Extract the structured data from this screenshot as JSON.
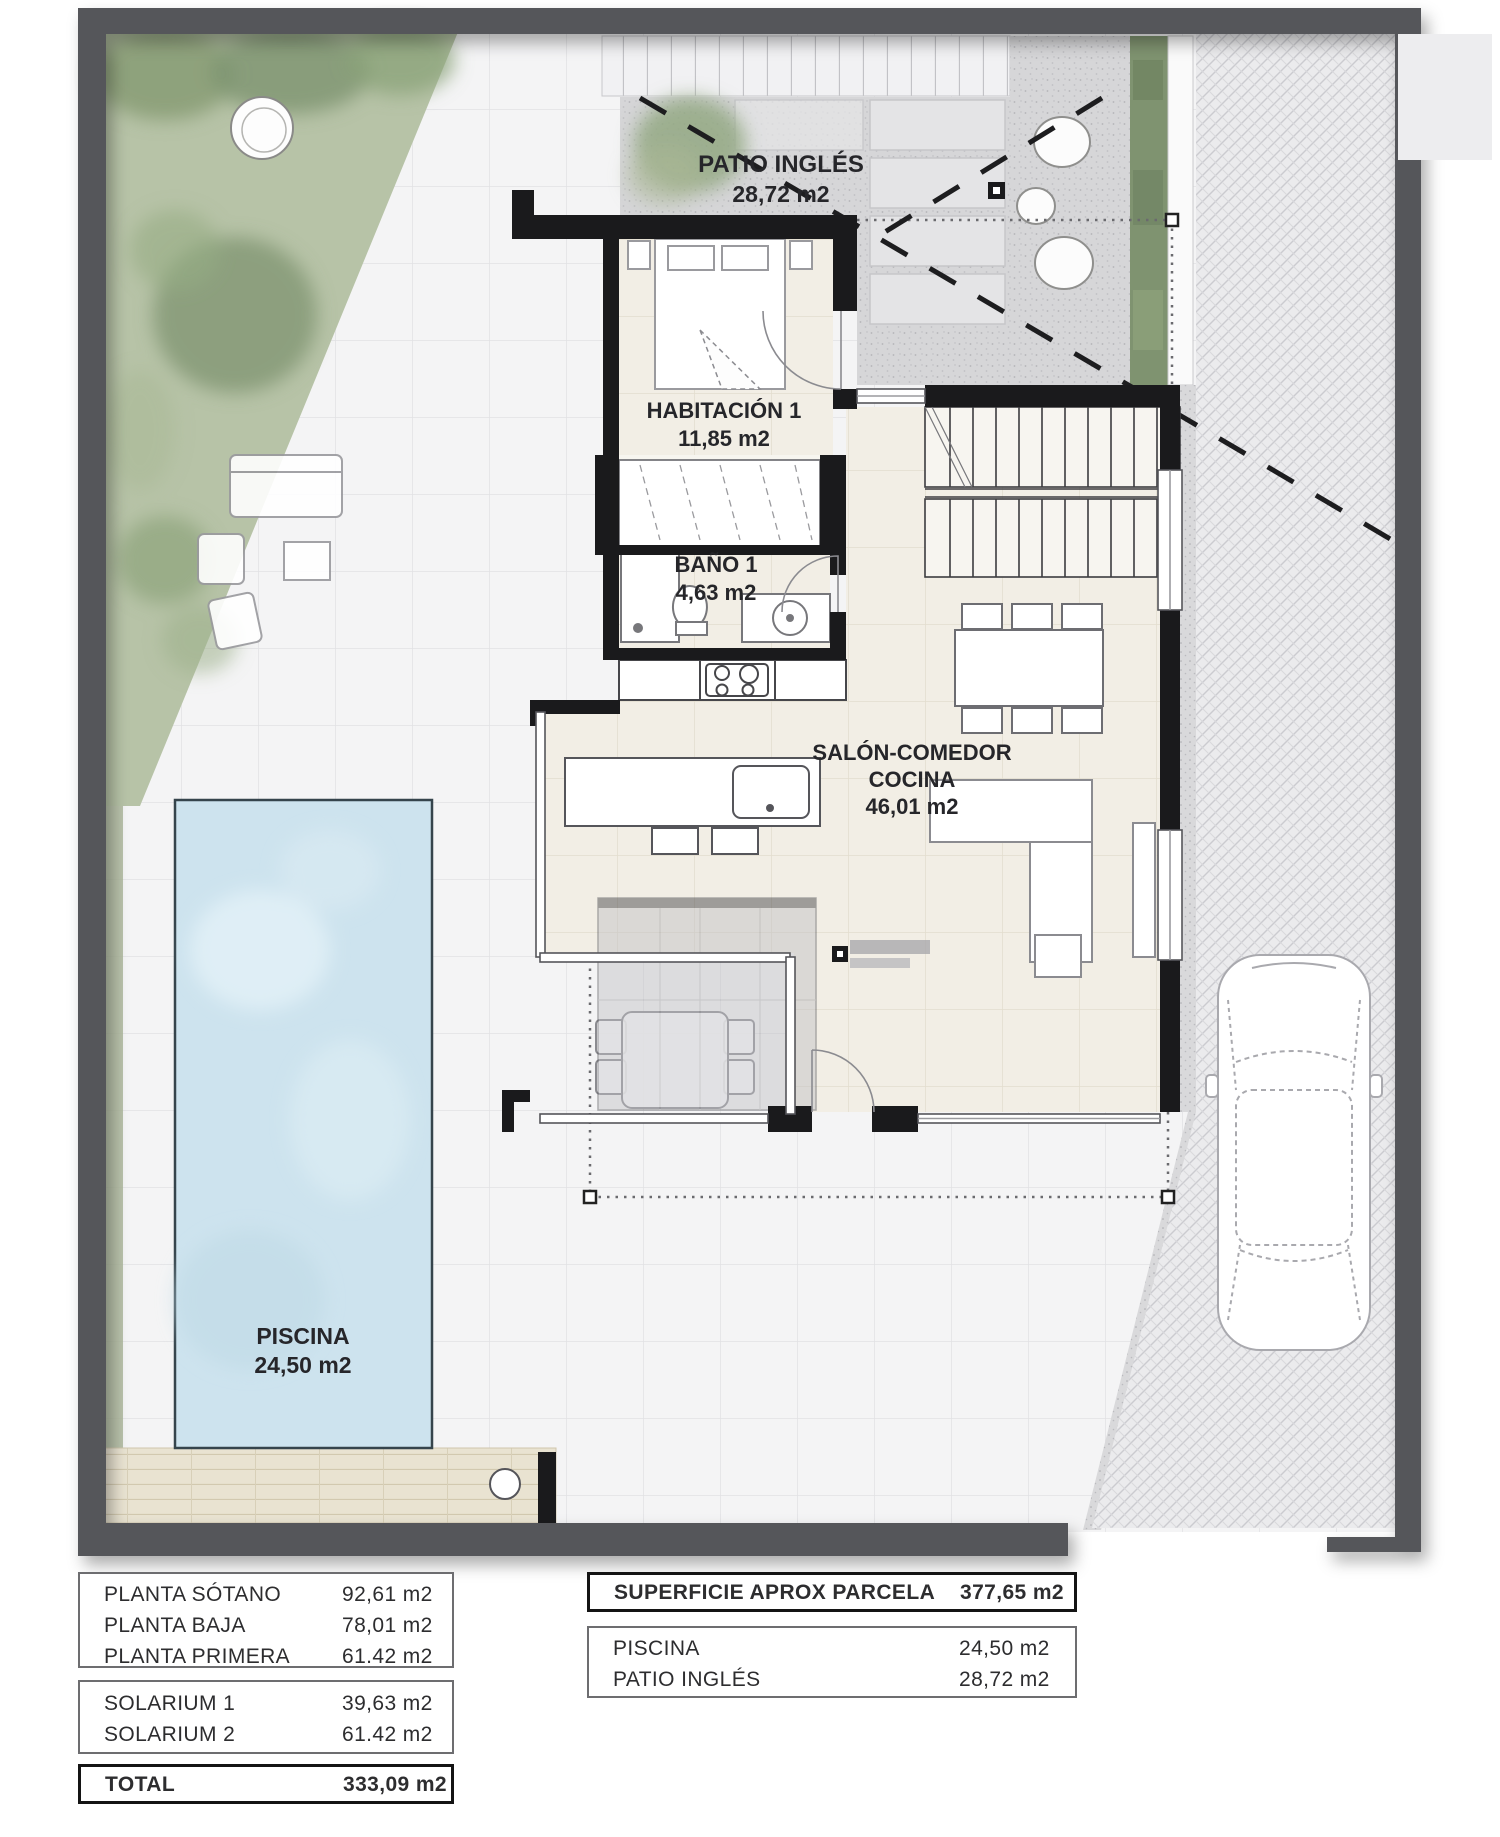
{
  "plan": {
    "patio": {
      "name": "PATIO INGLÉS",
      "area": "28,72 m2"
    },
    "bedroom": {
      "name": "HABITACIÓN 1",
      "area": "11,85 m2"
    },
    "bath": {
      "name": "BAÑO 1",
      "area": "4,63 m2"
    },
    "salon": {
      "line1": "SALÓN-COMEDOR",
      "line2": "COCINA",
      "area": "46,01 m2"
    },
    "pool": {
      "name": "PISCINA",
      "area": "24,50 m2"
    }
  },
  "tables": {
    "plantas": {
      "rows": [
        {
          "label": "PLANTA SÓTANO",
          "value": "92,61 m2"
        },
        {
          "label": "PLANTA BAJA",
          "value": "78,01 m2"
        },
        {
          "label": "PLANTA PRIMERA",
          "value": "61.42 m2"
        }
      ]
    },
    "solarium": {
      "rows": [
        {
          "label": "SOLARIUM 1",
          "value": "39,63 m2"
        },
        {
          "label": "SOLARIUM 2",
          "value": "61.42 m2"
        }
      ]
    },
    "total": {
      "label": "TOTAL",
      "value": "333,09 m2"
    },
    "parcela": {
      "label": "SUPERFICIE APROX PARCELA",
      "value": "377,65 m2"
    },
    "exterior": {
      "rows": [
        {
          "label": "PISCINA",
          "value": "24,50 m2"
        },
        {
          "label": "PATIO INGLÉS",
          "value": "28,72 m2"
        }
      ]
    }
  },
  "colors": {
    "boundary_wall": "#55565a",
    "interior_wall": "#1a1a1c",
    "pool_water": "#cde3ee",
    "garden_green": "#b7c3a7",
    "hedge_green": "#7f9370",
    "floor_cream": "#f2eee5",
    "tile_light": "#f4f4f5",
    "deck_wood": "#e9e3d1"
  }
}
